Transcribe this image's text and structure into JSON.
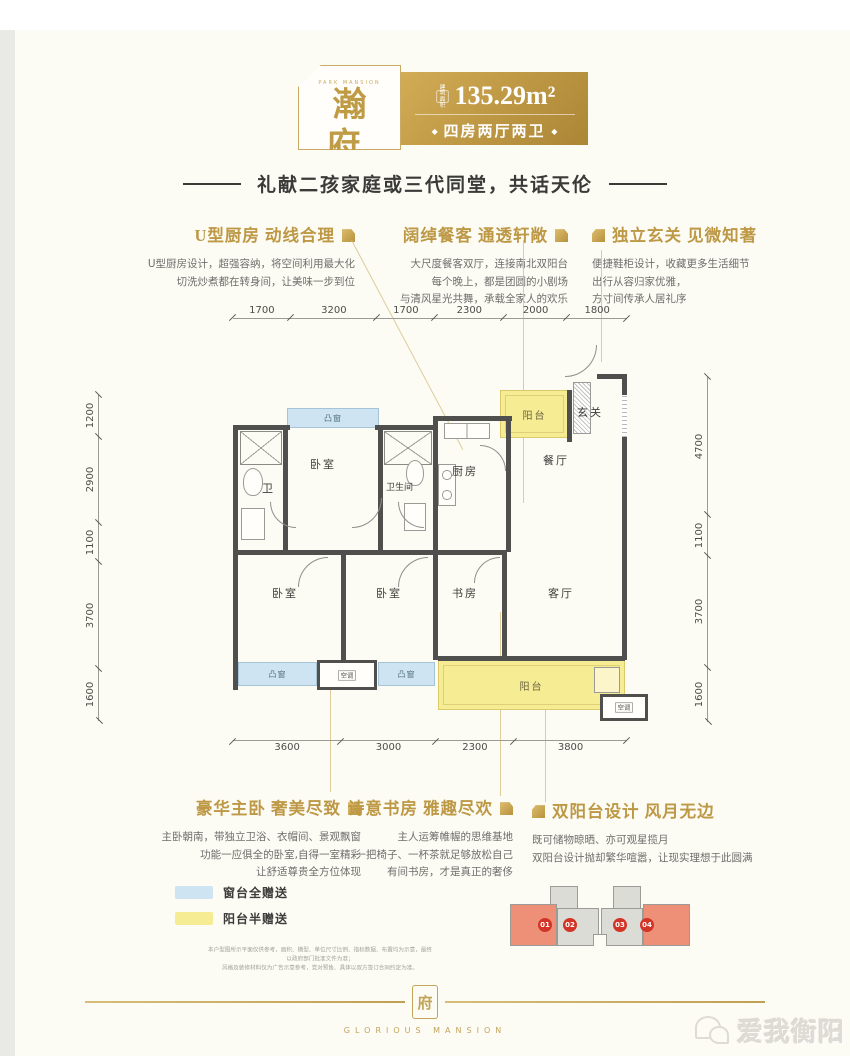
{
  "header": {
    "brand_small": "PARK MANSION",
    "name": "瀚府",
    "unit_tag": "3#01/04户型",
    "area_label": "建筑面积",
    "area_value": "135.29m²",
    "layout_text": "四房两厅两卫",
    "layout_dot": "◆",
    "gold": "#c09a45"
  },
  "tagline": "礼献二孩家庭或三代同堂，共话天伦",
  "features_top": [
    {
      "title": "U型厨房 动线合理",
      "lines": [
        "U型厨房设计，超强容纳，将空间利用最大化",
        "切洗炒煮都在转身间，让美味一步到位"
      ]
    },
    {
      "title": "阔绰餐客 通透轩敞",
      "lines": [
        "大尺度餐客双厅，连接南北双阳台",
        "每个晚上，都是团圆的小剧场",
        "与清风星光共舞，承载全家人的欢乐"
      ]
    },
    {
      "title": "独立玄关 见微知著",
      "lines": [
        "便捷鞋柜设计，收藏更多生活细节",
        "出行从容归家优雅，",
        "方寸间传承人居礼序"
      ]
    }
  ],
  "features_bottom": [
    {
      "title": "豪华主卧  奢美尽致",
      "lines": [
        "主卧朝南，带独立卫浴、衣帽间、景观飘窗",
        "功能一应俱全的卧室,自得一室精彩",
        "让舒适尊贵全方位体现"
      ]
    },
    {
      "title": "诗意书房 雅趣尽欢",
      "lines": [
        "主人运筹帷幄的思维基地",
        "一把椅子、一杯茶就足够放松自己",
        "有间书房，才是真正的奢侈"
      ]
    },
    {
      "title": "双阳台设计 风月无边",
      "lines": [
        "既可储物晾晒、亦可观星揽月",
        "双阳台设计抛却繁华喧嚣，让现实理想于此圆满"
      ]
    }
  ],
  "plan": {
    "dims_top": [
      "1700",
      "3200",
      "1700",
      "2300",
      "2000",
      "1800"
    ],
    "dims_left": [
      "1200",
      "2900",
      "1100",
      "3700",
      "1600"
    ],
    "dims_right": [
      "4700",
      "1100",
      "3700",
      "1600"
    ],
    "dims_bottom": [
      "3600",
      "3000",
      "2300",
      "3800"
    ],
    "labels": {
      "bedroom": "卧室",
      "bath": "卫",
      "bathroom": "卫生间",
      "kitchen": "厨房",
      "dining": "餐厅",
      "entry": "玄关",
      "balcony": "阳台",
      "study": "书房",
      "living": "客厅",
      "bay_window": "凸窗",
      "ac": "空调"
    }
  },
  "legend": [
    {
      "color": "#cfe4f2",
      "label": "窗台全赠送"
    },
    {
      "color": "#f6ec93",
      "label": "阳台半赠送"
    }
  ],
  "keyplan": {
    "units": [
      {
        "no": "01",
        "highlight": true
      },
      {
        "no": "02",
        "highlight": false
      },
      {
        "no": "03",
        "highlight": false
      },
      {
        "no": "04",
        "highlight": true
      }
    ]
  },
  "disclaimer": [
    "本户型图所示平面仅供参考，面积、模型、单位尺寸比例、指标数据、布置均为示意，最终以政府部门批准文件为准；",
    "风格及装修材料仅为广告示意参考，党对预售、具体以双方签订合同约定为准。"
  ],
  "footer": {
    "emblem_glyph": "府",
    "logo_text": "GLORIOUS MANSION"
  },
  "watermark": "爱我衡阳"
}
